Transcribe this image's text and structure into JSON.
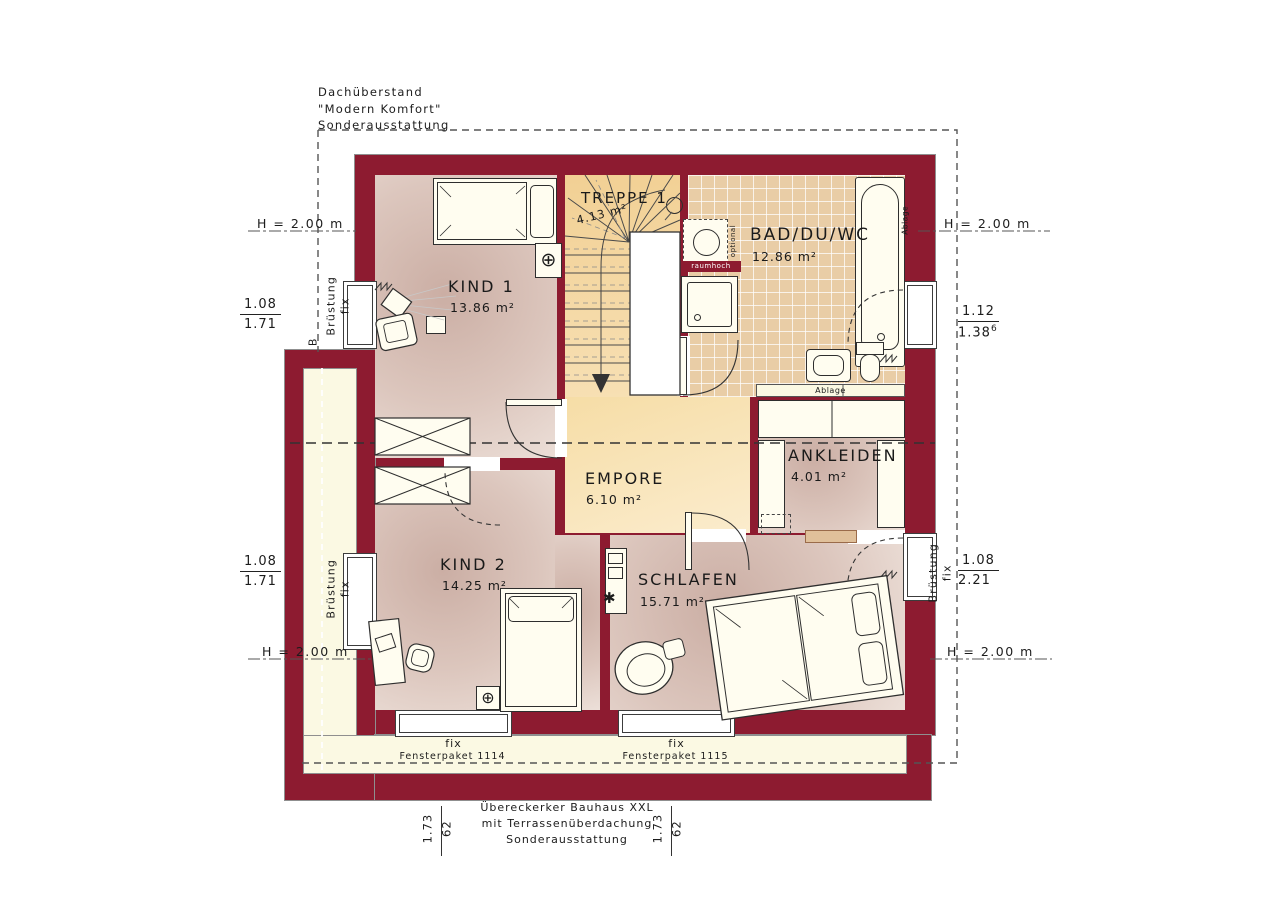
{
  "annotations": {
    "top_left": [
      "Dachüberstand",
      "\"Modern Komfort\"",
      "Sonderausstattung"
    ],
    "bottom_center": [
      "Übereckerker Bauhaus XXL",
      "mit Terrassenüberdachung",
      "Sonderausstattung"
    ],
    "height_line": "H = 2.00 m",
    "section_letter": "B",
    "parapet": {
      "line1": "Brüstung",
      "line2": "fix"
    },
    "dims": {
      "left_top": {
        "num": "1.08",
        "den": "1.71"
      },
      "left_mid": {
        "num": "1.08",
        "den": "1.71"
      },
      "right_top": {
        "num": "1.12",
        "den": "1.38",
        "den_sup": "6"
      },
      "right_mid": {
        "num": "1.08",
        "den": "2.21"
      },
      "bottom_left": {
        "w": "1.73",
        "h": "62"
      },
      "bottom_right": {
        "w": "1.73",
        "h": "62"
      }
    }
  },
  "rooms": {
    "kind1": {
      "name": "KIND 1",
      "area": "13.86 m²"
    },
    "treppe": {
      "name": "TREPPE 1",
      "area": "4.13 m²"
    },
    "bad": {
      "name": "BAD/DU/WC",
      "area": "12.86 m²"
    },
    "empore": {
      "name": "EMPORE",
      "area": "6.10 m²"
    },
    "ankleiden": {
      "name": "ANKLEIDEN",
      "area": "4.01 m²"
    },
    "kind2": {
      "name": "KIND 2",
      "area": "14.25 m²"
    },
    "schlafen": {
      "name": "SCHLAFEN",
      "area": "15.71 m²"
    }
  },
  "fixtures": {
    "shelf": "Ablage",
    "shelf_side": "Ablage",
    "full_height": "raumhoch",
    "optional": "optional"
  },
  "windows": {
    "fix_label": "fix",
    "package_1": "Fensterpaket 1114",
    "package_2": "Fensterpaket 1115"
  },
  "colors": {
    "wall": "#8d1b30",
    "room_floor": "#d8bfb6",
    "stair_floor": "#f2d094",
    "bath_tile": "#e9cda6",
    "terrace": "#fbf9e3"
  }
}
